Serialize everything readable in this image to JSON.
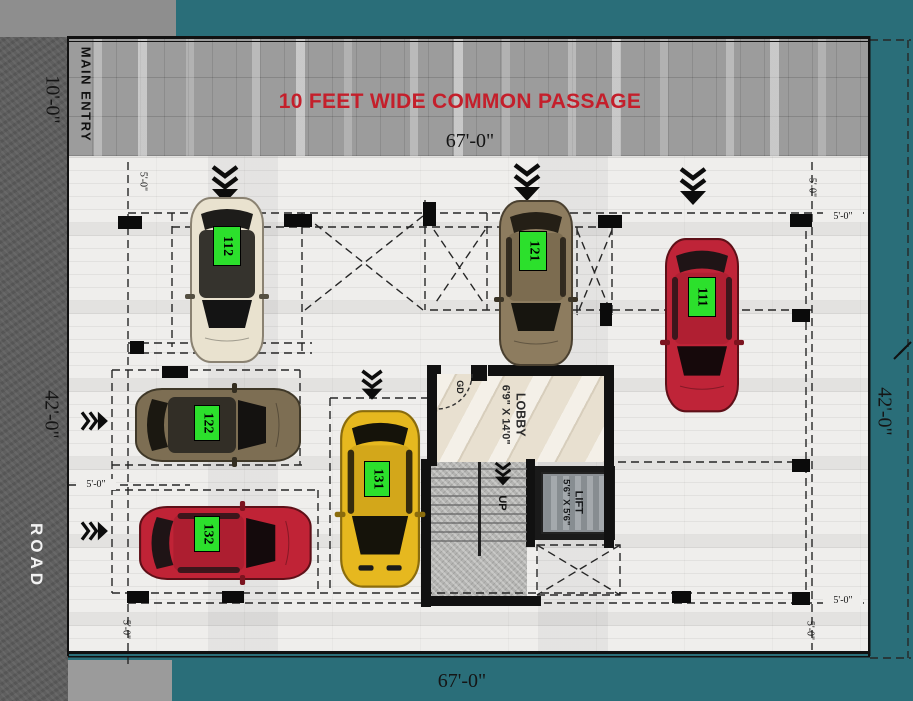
{
  "plan": {
    "passage_title": "10 FEET WIDE COMMON PASSAGE",
    "main_entry_label": "MAIN ENTRY",
    "road_label": "ROAD",
    "dims": {
      "width_top": "67'-0\"",
      "width_bottom": "67'-0\"",
      "depth_left": "42'-0\"",
      "depth_right": "42'-0\"",
      "entry_width": "10'-0\"",
      "offset_small": "5'-0\""
    },
    "lobby": {
      "label": "LOBBY",
      "size": "6'9\" X 14'0\"",
      "door_label": "GD"
    },
    "lift": {
      "label": "LIFT",
      "size": "5'6\" X 5'6\""
    },
    "stairs": {
      "direction_label": "UP"
    },
    "parking_spots": [
      {
        "id": "112",
        "car_color": "cream"
      },
      {
        "id": "121",
        "car_color": "bronze"
      },
      {
        "id": "111",
        "car_color": "red"
      },
      {
        "id": "122",
        "car_color": "bronze"
      },
      {
        "id": "131",
        "car_color": "yellow"
      },
      {
        "id": "132",
        "car_color": "red"
      }
    ],
    "colors": {
      "background_teal": "#2a6e79",
      "spot_label_green": "#2ce02c",
      "passage_text_red": "#c41f2b"
    }
  }
}
